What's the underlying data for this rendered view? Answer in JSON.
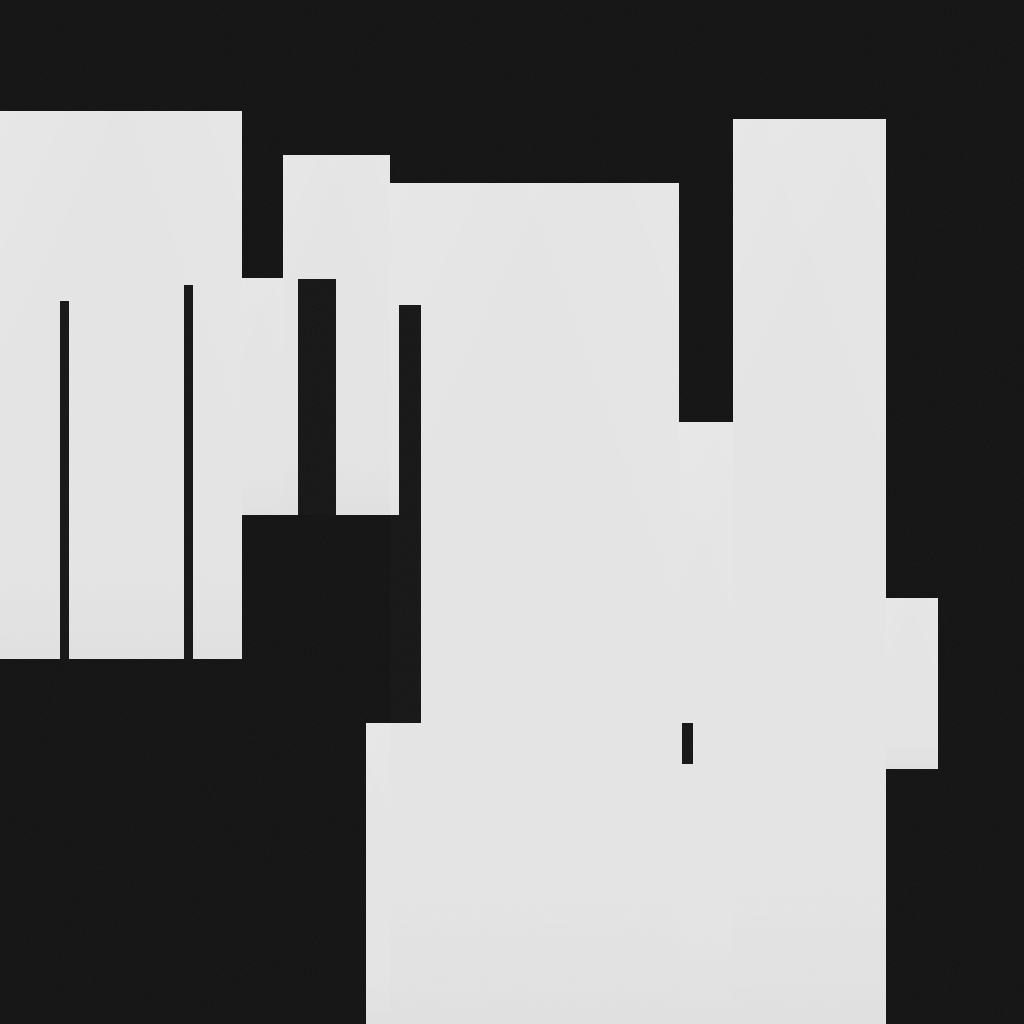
{
  "canvas": {
    "width": 1024,
    "height": 1024,
    "background_color": "#0b0b0b",
    "surface_color": "#e3e3e3",
    "mark_color": "#0e0e0e"
  },
  "shapes": {
    "gray_regions": [
      {
        "name": "panel-top-left",
        "x": 0,
        "y": 111,
        "w": 242,
        "h": 548
      },
      {
        "name": "panel-left-lower-slice",
        "x": 242,
        "y": 278,
        "w": 41,
        "h": 237
      },
      {
        "name": "panel-mid-upper",
        "x": 283,
        "y": 155,
        "w": 107,
        "h": 360
      },
      {
        "name": "panel-center",
        "x": 390,
        "y": 183,
        "w": 289,
        "h": 841
      },
      {
        "name": "panel-center-bridge",
        "x": 679,
        "y": 422,
        "w": 54,
        "h": 602
      },
      {
        "name": "panel-right-column",
        "x": 733,
        "y": 119,
        "w": 153,
        "h": 905
      },
      {
        "name": "panel-right-bump",
        "x": 886,
        "y": 598,
        "w": 52,
        "h": 171
      },
      {
        "name": "panel-bottom-left-extension",
        "x": 366,
        "y": 723,
        "w": 24,
        "h": 301
      }
    ],
    "black_marks": [
      {
        "name": "thin-bar-left",
        "x": 60,
        "y": 301,
        "w": 9,
        "h": 358
      },
      {
        "name": "thin-bar-mid-left",
        "x": 184,
        "y": 285,
        "w": 9,
        "h": 374
      },
      {
        "name": "wide-bar-mid",
        "x": 298,
        "y": 279,
        "w": 38,
        "h": 236
      },
      {
        "name": "bar-center-upper",
        "x": 399,
        "y": 305,
        "w": 22,
        "h": 210
      },
      {
        "name": "bar-center-lower",
        "x": 390,
        "y": 515,
        "w": 31,
        "h": 208
      },
      {
        "name": "small-notch-bar",
        "x": 682,
        "y": 723,
        "w": 11,
        "h": 41
      }
    ]
  }
}
